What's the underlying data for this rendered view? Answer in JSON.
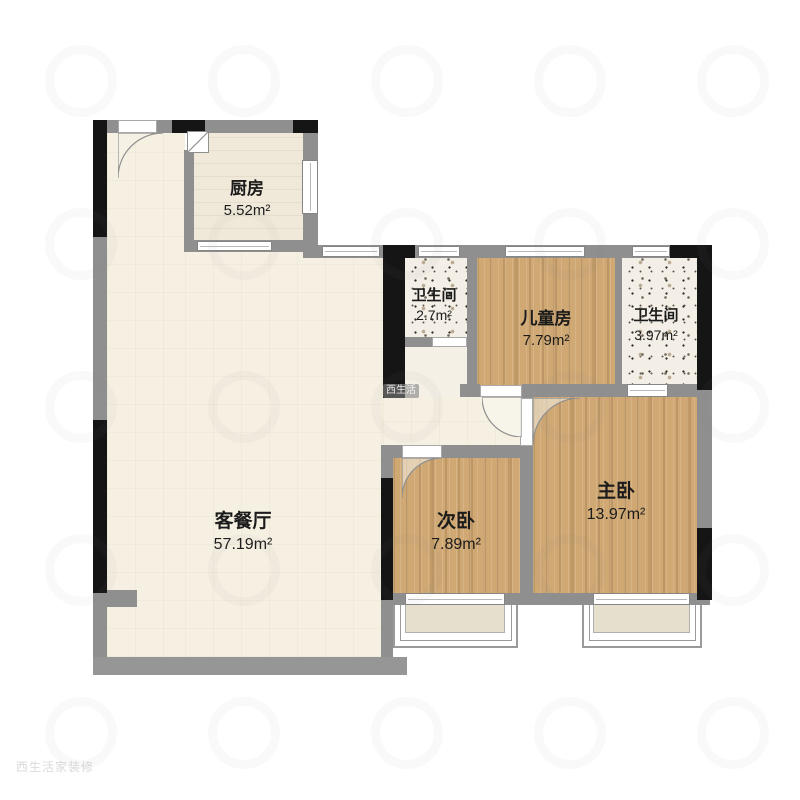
{
  "plan": {
    "title": "apartment-floor-plan",
    "rooms": [
      {
        "id": "kitchen",
        "name": "厨房",
        "area": "5.52m²"
      },
      {
        "id": "bath1",
        "name": "卫生间",
        "area": "2.7m²"
      },
      {
        "id": "kids",
        "name": "儿童房",
        "area": "7.79m²"
      },
      {
        "id": "bath2",
        "name": "卫生间",
        "area": "3.97m²"
      },
      {
        "id": "living",
        "name": "客餐厅",
        "area": "57.19m²"
      },
      {
        "id": "second",
        "name": "次卧",
        "area": "7.89m²"
      },
      {
        "id": "master",
        "name": "主卧",
        "area": "13.97m²"
      }
    ],
    "colors": {
      "wall_gray": "#8f8f8f",
      "wall_black": "#151515",
      "wood_floor": "#cfa873",
      "living_floor": "#f5f0e2",
      "kitchen_floor": "#f0e9da",
      "bath_floor": "#f3efe6",
      "bay_inner": "#e6dfcd"
    }
  },
  "watermark": {
    "chip": "西生活",
    "corner": "西生活家装修"
  }
}
